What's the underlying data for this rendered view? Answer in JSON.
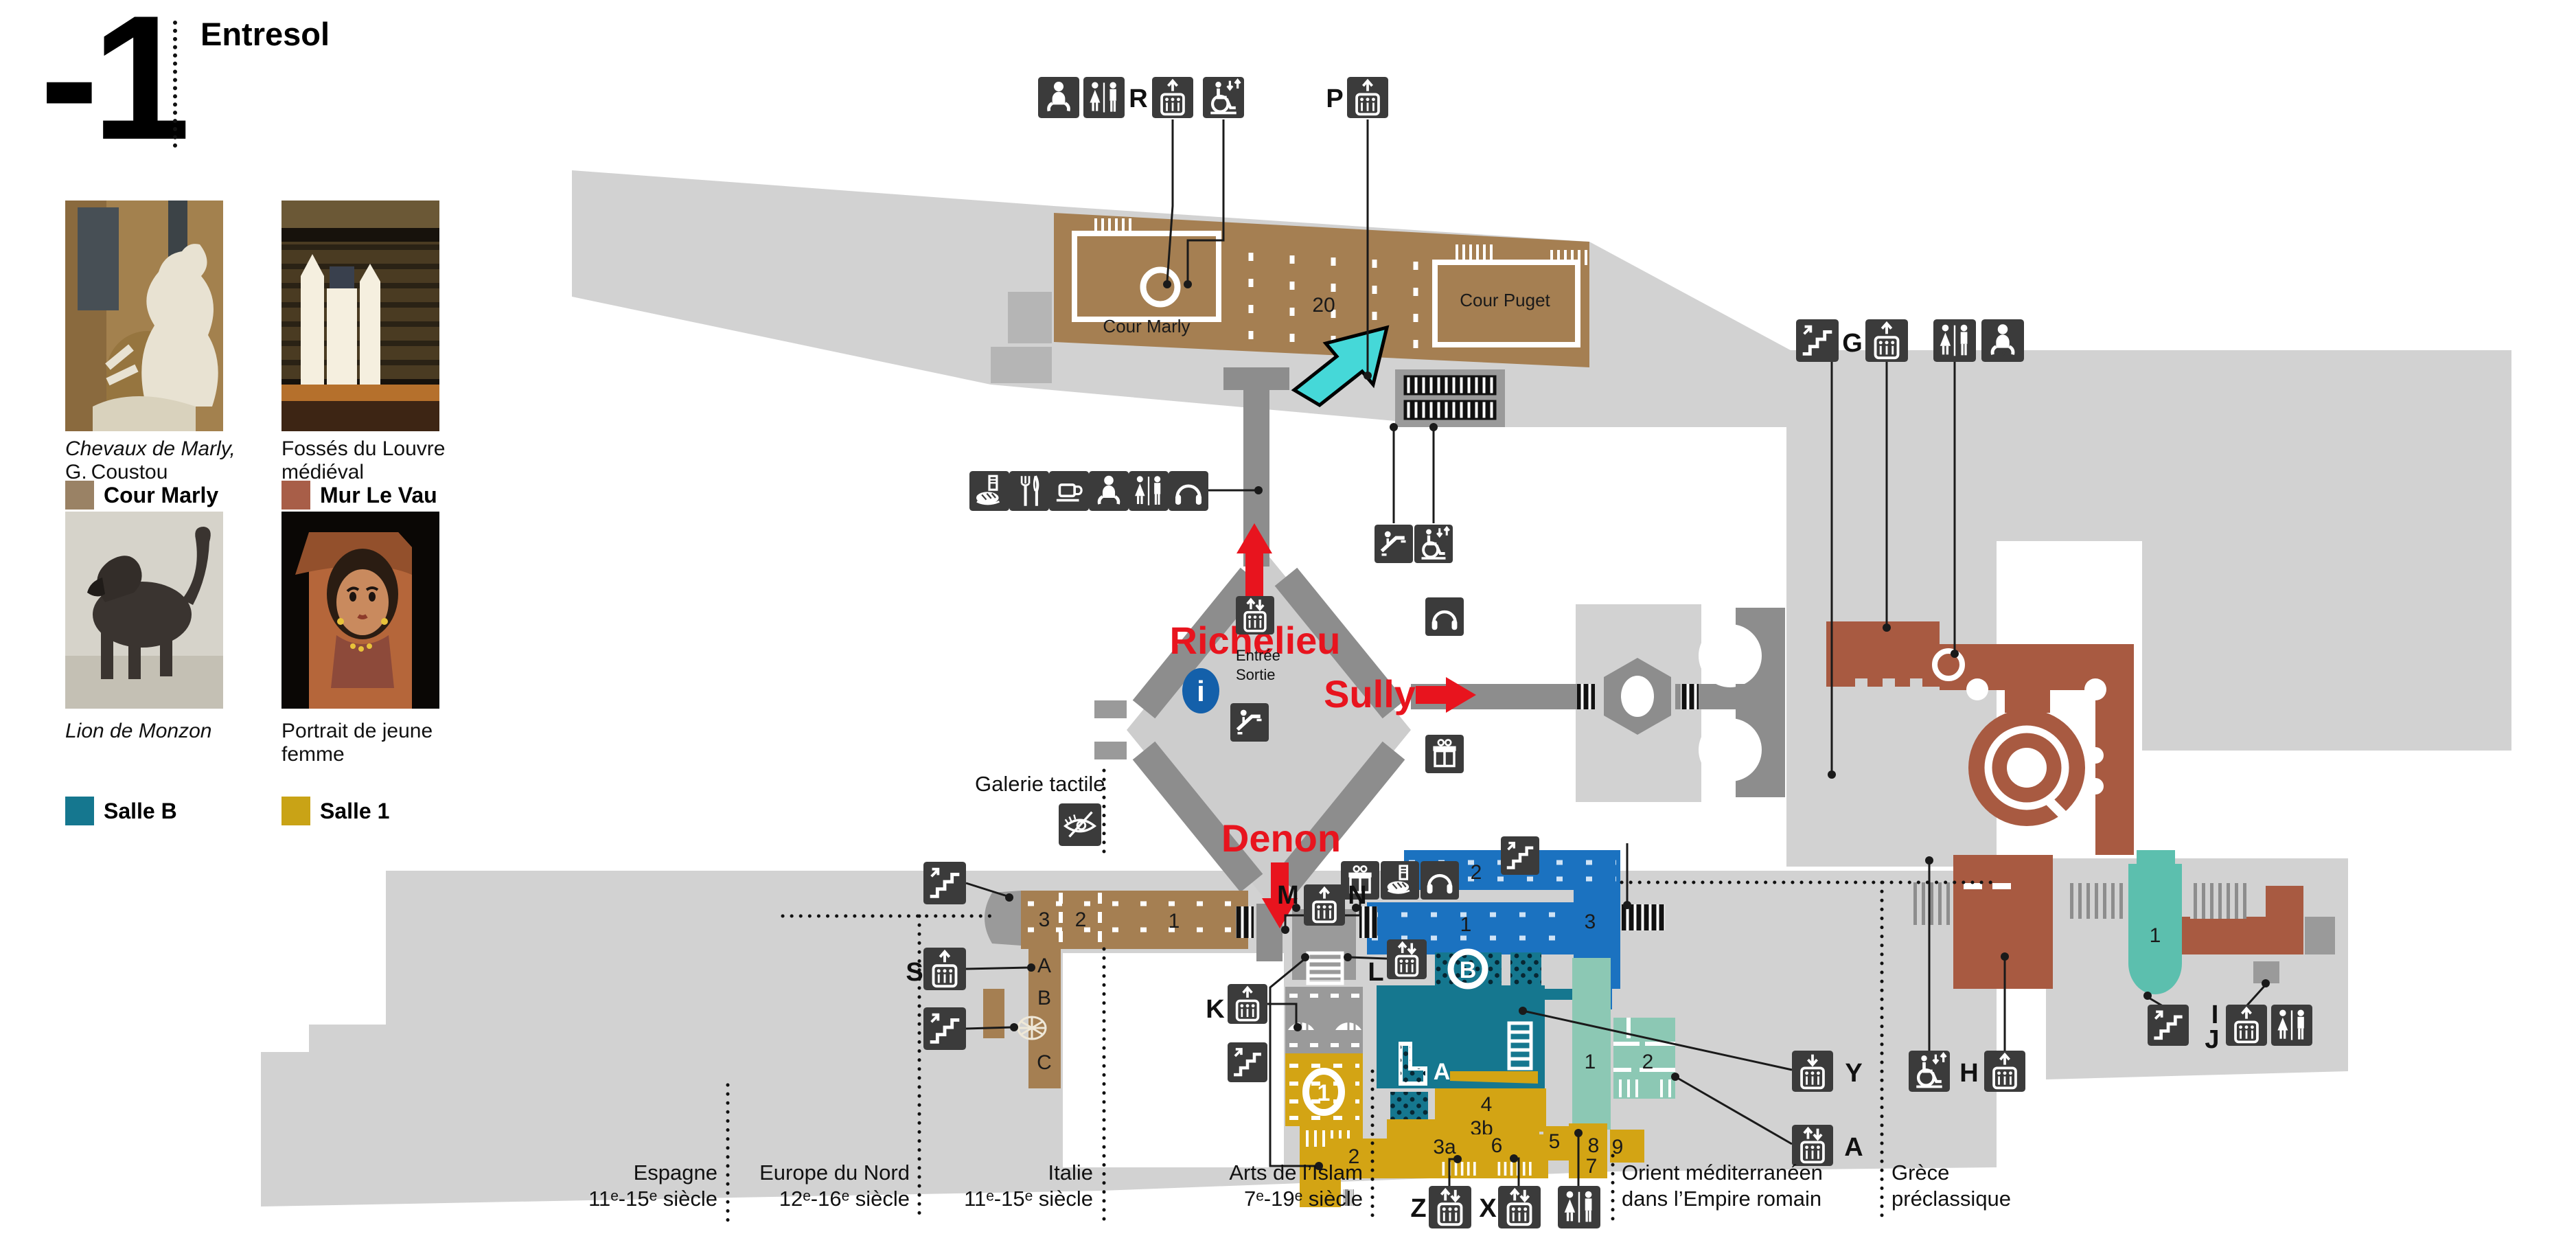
{
  "header": {
    "level": "-1",
    "title": "Entresol"
  },
  "sidebar": {
    "artworks": [
      {
        "caption_line1": "Chevaux de Marly,",
        "caption_line2": "G. Coustou",
        "italic": true,
        "legend_label": "Cour Marly",
        "legend_color": "#9a8265"
      },
      {
        "caption_line1": "Fossés du Louvre",
        "caption_line2": "médiéval",
        "italic": false,
        "legend_label": "Mur Le Vau",
        "legend_color": "#a85e48"
      },
      {
        "caption_line1": "Lion de Monzon",
        "caption_line2": "",
        "italic": true,
        "legend_label": "Salle B",
        "legend_color": "#15778f"
      },
      {
        "caption_line1": "Portrait de jeune",
        "caption_line2": "femme",
        "italic": false,
        "legend_label": "Salle 1",
        "legend_color": "#c9a316"
      }
    ]
  },
  "map": {
    "wings": {
      "richelieu": "Richelieu",
      "sully": "Sully",
      "denon": "Denon"
    },
    "courts": {
      "marly": "Cour Marly",
      "puget": "Cour Puget",
      "room20": "20"
    },
    "entrance": {
      "line1": "Entrée",
      "line2": "Sortie"
    },
    "info": "i",
    "tactile": "Galerie tactile",
    "letters": {
      "r": "R",
      "p": "P",
      "g": "G",
      "s": "S",
      "k": "K",
      "l": "L",
      "m": "M",
      "n": "N",
      "y": "Y",
      "a": "A",
      "h": "H",
      "i": "I",
      "j": "J",
      "z": "Z",
      "x": "X"
    },
    "rooms": {
      "tan3": "3",
      "tan2": "2",
      "tan1": "1",
      "tanA": "A",
      "tanB": "B",
      "tanC": "C",
      "blue1": "1",
      "blue2": "2",
      "blue3": "3",
      "tealA": "A",
      "tealB": "B",
      "gold1": "1",
      "gold2": "2",
      "gold3a": "3a",
      "gold3b": "3b",
      "gold4": "4",
      "gold5": "5",
      "gold6": "6",
      "gold7": "7",
      "gold8": "8",
      "gold9": "9",
      "orient1": "1",
      "orient2": "2",
      "grece1": "1"
    },
    "sections": [
      {
        "name": "Espagne",
        "period": "11ᵉ-15ᵉ siècle"
      },
      {
        "name": "Europe du Nord",
        "period": "12ᵉ-16ᵉ siècle"
      },
      {
        "name": "Italie",
        "period": "11ᵉ-15ᵉ siècle"
      },
      {
        "name": "Arts de l’Islam",
        "period": "7ᵉ-19ᵉ siècle"
      },
      {
        "name": "Orient méditerranéen",
        "period": "dans l’Empire romain"
      },
      {
        "name": "Grèce",
        "period": "préclassique"
      }
    ],
    "colors": {
      "tan": "#a57f52",
      "maroon": "#a85a41",
      "blue": "#1b72c0",
      "teal_dark": "#15778f",
      "gold": "#d3a414",
      "orient_teal": "#8cc8b4",
      "grece_teal": "#5cbfae",
      "red": "#e8141e",
      "cyan": "#45d8d8",
      "corridor": "#8d8d8d",
      "building": "#d2d2d2",
      "icon_tile": "#3b3b3b",
      "info_blue": "#1460aa"
    }
  }
}
